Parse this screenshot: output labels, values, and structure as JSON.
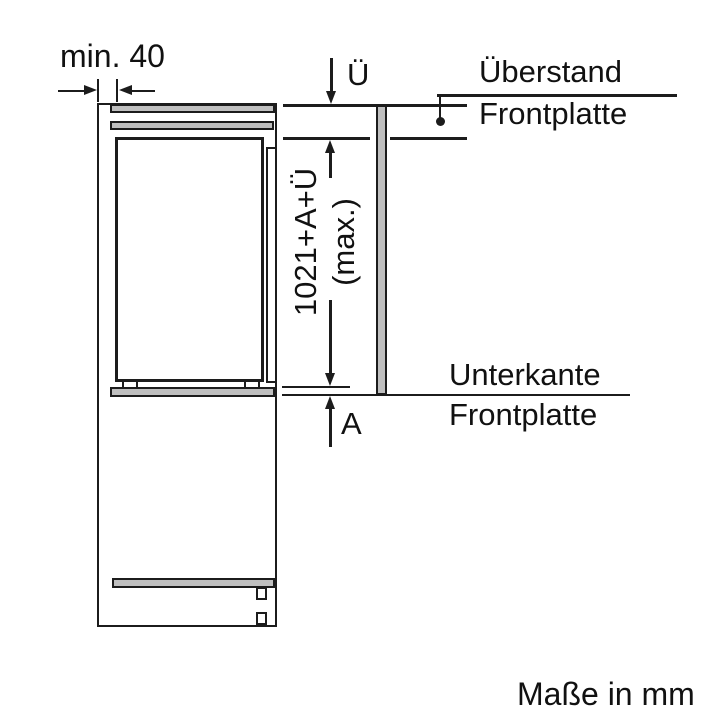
{
  "diagram": {
    "units_note": "Maße in mm",
    "dimensions": {
      "min_top_clearance": "min. 40",
      "overhang": "Ü",
      "panel_height_line1": "1021+A+Ü",
      "panel_height_line2": "(max.)",
      "bottom_extension": "A"
    },
    "labels": {
      "overhang_line1": "Überstand",
      "overhang_line2": "Frontplatte",
      "bottom_edge_line1": "Unterkante",
      "bottom_edge_line2": "Frontplatte"
    },
    "icons": {
      "arrowhead_up": "css-triangle-up",
      "arrowhead_down": "css-triangle-down",
      "arrowhead_left": "css-triangle-left",
      "arrowhead_right": "css-triangle-right",
      "leader_dot": "filled-circle"
    },
    "colors": {
      "line": "#1c1c1c",
      "panel_fill": "#bfbfbf",
      "background": "#ffffff"
    }
  }
}
